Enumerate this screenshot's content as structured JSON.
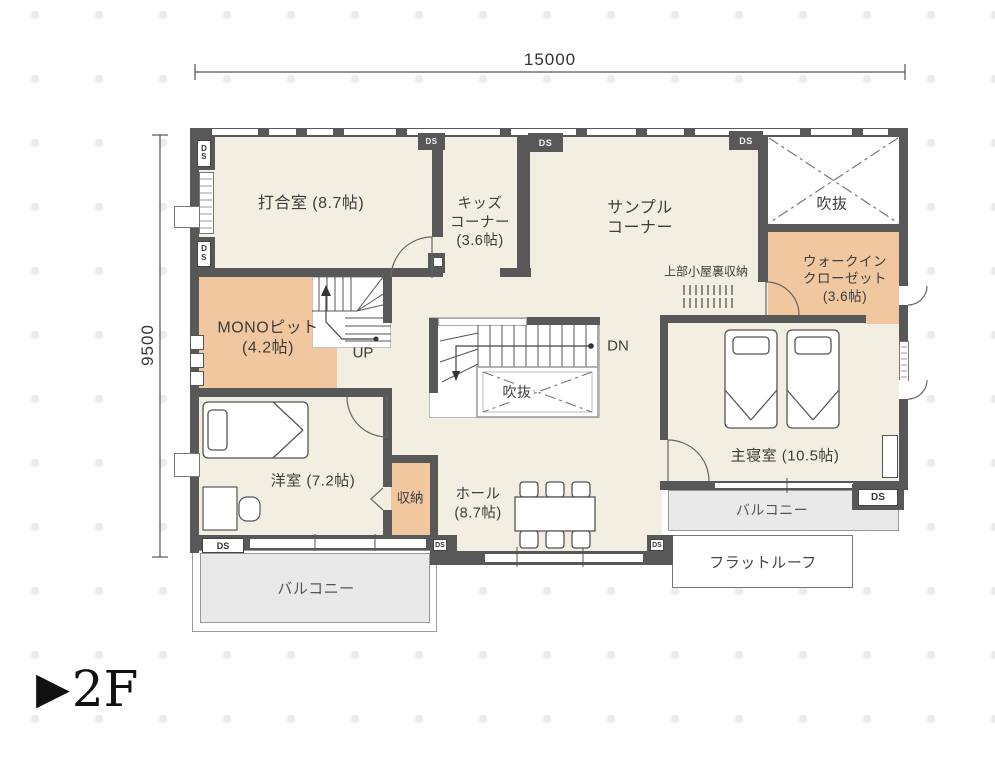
{
  "floor_marker": {
    "triangle": "▶",
    "label": "2F"
  },
  "dimensions": {
    "width_mm": "15000",
    "height_mm": "9500"
  },
  "rooms": {
    "meeting": "打合室 (8.7帖)",
    "kids": "キッズ\nコーナー\n(3.6帖)",
    "sample": "サンプル\nコーナー",
    "void_top": "吹抜",
    "wic": "ウォークイン\nクローゼット\n(3.6帖)",
    "attic_storage": "上部小屋裏収納",
    "mono_pit": "MONOピット\n(4.2帖)",
    "master_bedroom": "主寝室 (10.5帖)",
    "western_room": "洋室 (7.2帖)",
    "closet": "収納",
    "hall": "ホール\n(8.7帖)",
    "void_center": "吹抜",
    "balcony_left": "バルコニー",
    "balcony_right": "バルコニー",
    "flat_roof": "フラットルーフ"
  },
  "stairs": {
    "up": "UP",
    "down": "DN"
  },
  "duct": {
    "ds": "DS",
    "ds_vertical": "D\nS"
  },
  "colors": {
    "wall": "#585858",
    "floor": "#f2eee1",
    "accent_room": "#f0c79f",
    "balcony": "#e9e9e9",
    "dots": "#ececec"
  }
}
